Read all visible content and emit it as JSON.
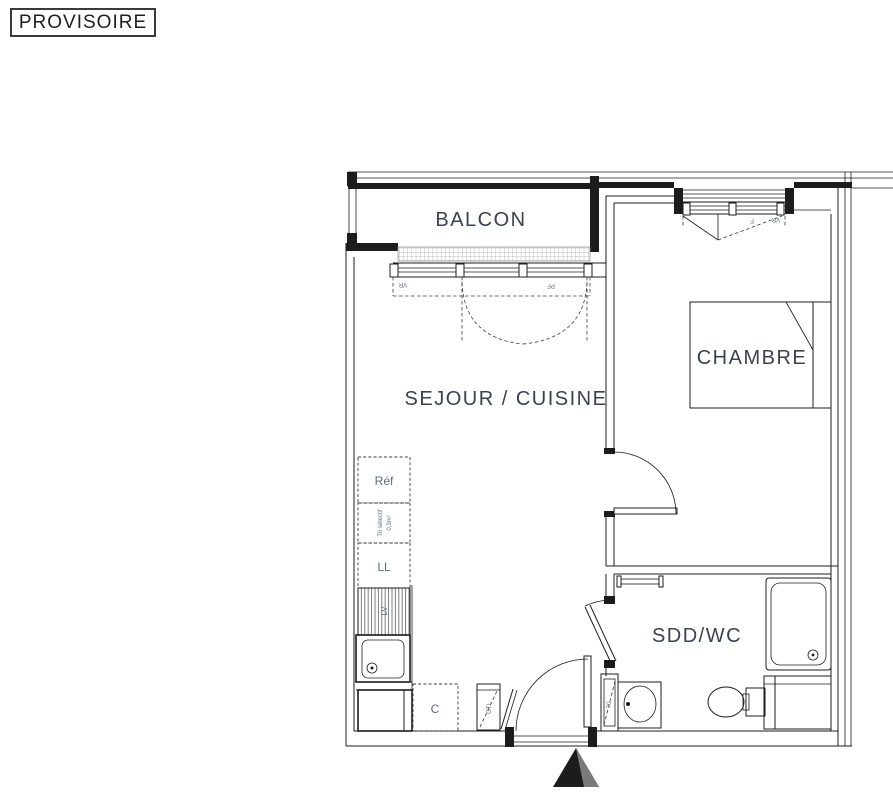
{
  "stamp": {
    "text": "PROVISOIRE"
  },
  "floor_plan": {
    "rooms": [
      {
        "id": "balcon",
        "label": "BALCON"
      },
      {
        "id": "sejour_cuisine",
        "label": "SEJOUR / CUISINE"
      },
      {
        "id": "chambre",
        "label": "CHAMBRE"
      },
      {
        "id": "sdd_wc",
        "label": "SDD/WC"
      }
    ],
    "fixtures": {
      "fridge": "Réf",
      "recycling_line1": "Tri sélectif",
      "recycling_line2": "0,3m²",
      "washing_machine": "LL",
      "dishwasher": "LV",
      "cooker": "C",
      "technical_duct": "GTL",
      "duct_width": "70"
    },
    "window_tags": {
      "sejour_vr": "VR",
      "sejour_pf": "PF",
      "chambre_f": "F",
      "chambre_vr": "VR"
    },
    "colors": {
      "line": "#1c1c1c",
      "label_large": "#3a4150",
      "label_small": "#5d6c84",
      "hatch": "#a6a6a6",
      "hatch_dark": "#6f6f6f",
      "stamp_text": "#1f1f1f"
    }
  }
}
